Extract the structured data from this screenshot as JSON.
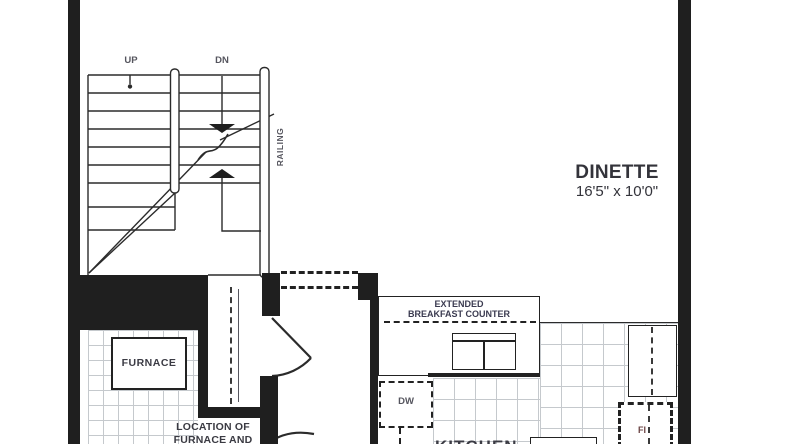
{
  "plan": {
    "stairs": {
      "up_label": "UP",
      "dn_label": "DN",
      "railing_label": "RAILING"
    },
    "rooms": {
      "dinette": {
        "name": "DINETTE",
        "dimensions": "16'5\" x 10'0\""
      },
      "kitchen": {
        "name": "KITCHEN"
      },
      "furnace_room": {
        "furnace_label": "FURNACE",
        "note_line1": "LOCATION OF",
        "note_line2": "FURNACE AND"
      }
    },
    "fixtures": {
      "breakfast_counter_line1": "EXTENDED",
      "breakfast_counter_line2": "BREAKFAST COUNTER",
      "dishwasher_label": "DW",
      "fridge_label_partial": "FI"
    },
    "colors": {
      "wall": "#1f1f1f",
      "line": "#2b2b2b",
      "tile_line": "#c5c9cd",
      "text": "#3b3b44",
      "muted_text": "#55555e"
    }
  }
}
